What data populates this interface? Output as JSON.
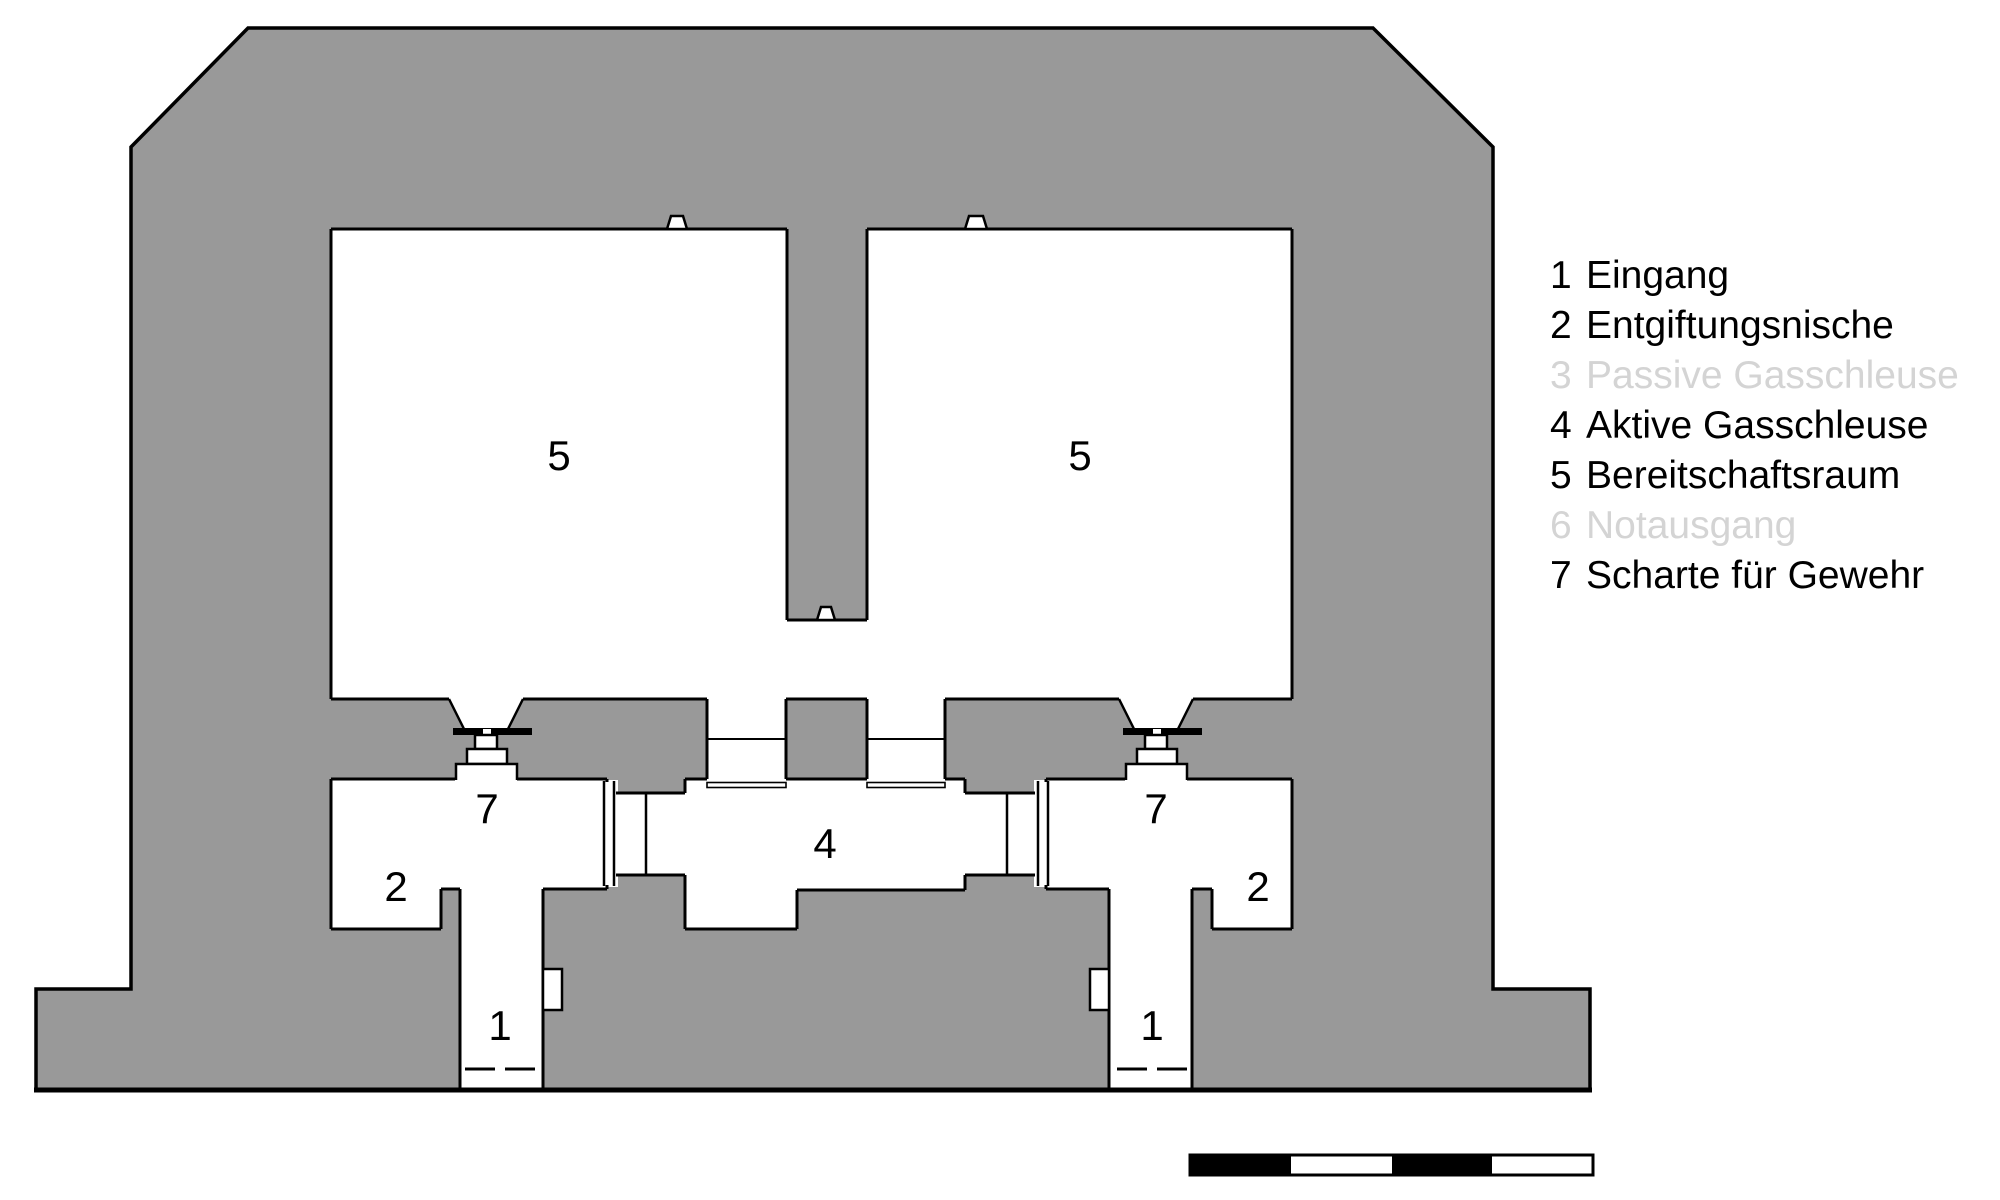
{
  "title": "Bunker floor plan",
  "colors": {
    "concrete": "#999999",
    "outline": "#000000",
    "dimmed_text": "#d4d4d4",
    "scale_black": "#000000",
    "scale_white": "#ffffff"
  },
  "legend": {
    "items": [
      {
        "number": "1",
        "label": "Eingang",
        "dimmed": false
      },
      {
        "number": "2",
        "label": "Entgiftungsnische",
        "dimmed": false
      },
      {
        "number": "3",
        "label": "Passive Gasschleuse",
        "dimmed": true
      },
      {
        "number": "4",
        "label": "Aktive Gasschleuse",
        "dimmed": false
      },
      {
        "number": "5",
        "label": "Bereitschaftsraum",
        "dimmed": false
      },
      {
        "number": "6",
        "label": "Notausgang",
        "dimmed": true
      },
      {
        "number": "7",
        "label": "Scharte für Gewehr",
        "dimmed": false
      }
    ]
  },
  "plan": {
    "labels": {
      "ready_room_left": "5",
      "ready_room_right": "5",
      "airlock": "4",
      "rifle_port_left": "7",
      "rifle_port_right": "7",
      "decon_left": "2",
      "decon_right": "2",
      "entrance_left": "1",
      "entrance_right": "1"
    }
  },
  "scale_bar": {
    "segments": [
      {
        "fill": "#000000"
      },
      {
        "fill": "#ffffff"
      },
      {
        "fill": "#000000"
      },
      {
        "fill": "#ffffff"
      }
    ]
  }
}
